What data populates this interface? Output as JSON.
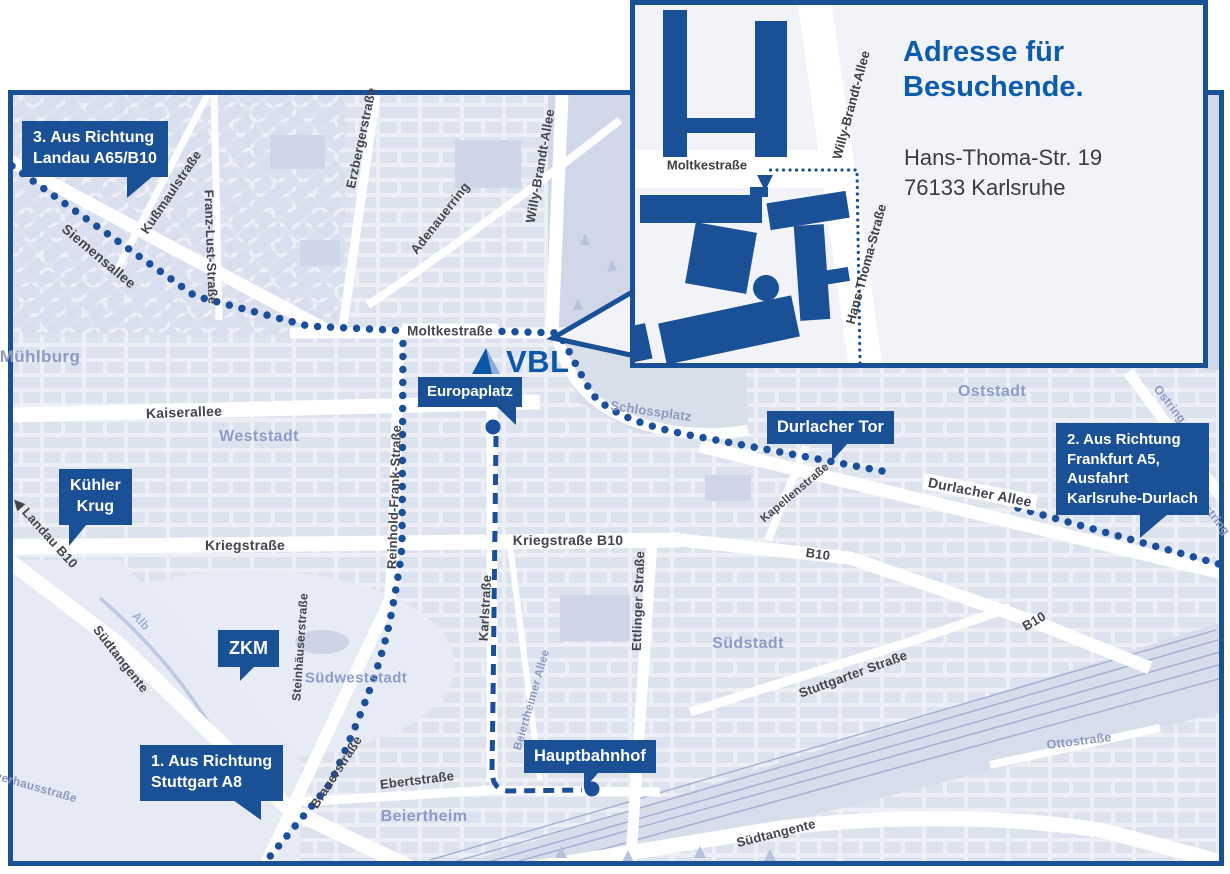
{
  "colors": {
    "accent_blue": "#1a5096",
    "route_blue": "#1a4f9c",
    "title_blue": "#0d5cab",
    "logo_blue": "#0a57a8",
    "map_background": "#edeff6",
    "district_label": "#8d9bc7"
  },
  "logo_text": "VBL",
  "inset": {
    "title_line1": "Adresse für",
    "title_line2": "Besuchende.",
    "address_line1": "Hans-Thoma-Str. 19",
    "address_line2": "76133 Karlsruhe",
    "street_moltke": "Moltkestraße",
    "street_willy": "Willy-Brandt-Allee",
    "street_hans_thoma": "Hans-Thoma-Straße"
  },
  "callouts": [
    {
      "id": "route3",
      "lines": [
        "3. Aus Richtung",
        "Landau A65/B10"
      ]
    },
    {
      "id": "kuehler-krug",
      "lines": [
        "Kühler",
        "Krug"
      ]
    },
    {
      "id": "zkm",
      "lines": [
        "ZKM"
      ]
    },
    {
      "id": "route1",
      "lines": [
        "1. Aus Richtung",
        "Stuttgart A8"
      ]
    },
    {
      "id": "europaplatz",
      "lines": [
        "Europaplatz"
      ]
    },
    {
      "id": "durlacher-tor",
      "lines": [
        "Durlacher Tor"
      ]
    },
    {
      "id": "hauptbahnhof",
      "lines": [
        "Hauptbahnhof"
      ]
    },
    {
      "id": "route2",
      "lines": [
        "2. Aus Richtung",
        "Frankfurt A5,",
        "Ausfahrt",
        "Karlsruhe-Durlach"
      ]
    }
  ],
  "street_labels": [
    {
      "text": "Siemensallee"
    },
    {
      "text": "Kußmaulstraße"
    },
    {
      "text": "Franz-Lust-Straße"
    },
    {
      "text": "Erzbergerstraße"
    },
    {
      "text": "Adenauerring"
    },
    {
      "text": "Willy-Brandt-Allee"
    },
    {
      "text": "Moltkestraße"
    },
    {
      "text": "Kaiserallee"
    },
    {
      "text": "Kriegstraße"
    },
    {
      "text": "Kriegstraße B10"
    },
    {
      "text": "Reinhold-Frank-Straße"
    },
    {
      "text": "Karlstraße"
    },
    {
      "text": "Ettlinger Straße"
    },
    {
      "text": "Kapellenstraße"
    },
    {
      "text": "Durlacher Allee"
    },
    {
      "text": "Ostring"
    },
    {
      "text": "Ostring"
    },
    {
      "text": "B10"
    },
    {
      "text": "B10"
    },
    {
      "text": "◀ Landau B10"
    },
    {
      "text": "Südtangente"
    },
    {
      "text": "Alb"
    },
    {
      "text": "Steinhäuserstraße"
    },
    {
      "text": "Brauerstraße"
    },
    {
      "text": "Ebertstraße"
    },
    {
      "text": "Beiertheimer Allee"
    },
    {
      "text": "Schlossplatz"
    },
    {
      "text": "Stuttgarter Straße"
    },
    {
      "text": "Ottostraße"
    },
    {
      "text": "Südtangente"
    },
    {
      "text": "verhausstraße"
    }
  ],
  "district_labels": [
    {
      "text": "Mühlburg"
    },
    {
      "text": "Weststadt"
    },
    {
      "text": "Oststadt"
    },
    {
      "text": "Südstadt"
    },
    {
      "text": "Südweststadt"
    },
    {
      "text": "Beiertheim"
    }
  ]
}
